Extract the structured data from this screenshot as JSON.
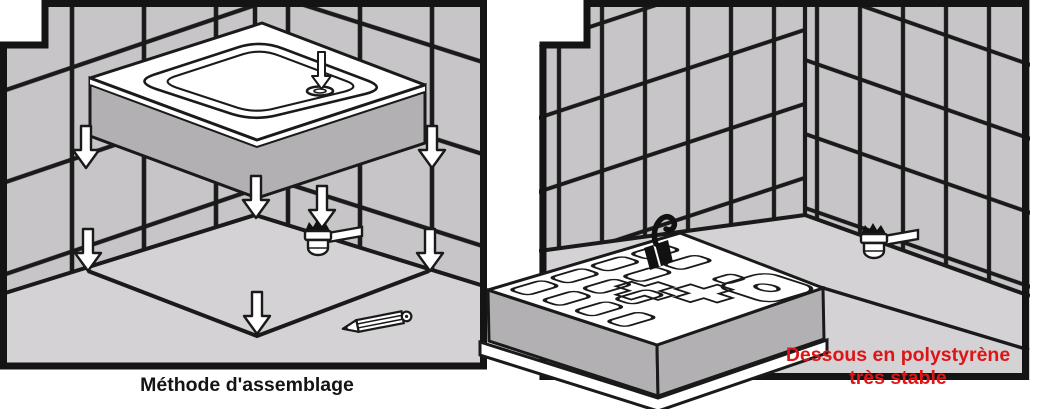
{
  "figure": {
    "type": "installation-instructions-illustration",
    "subject": "shower tray assembly in tiled corner"
  },
  "panels": {
    "left": {
      "caption": "Méthode d'assemblage",
      "elements": [
        "tiled-walls",
        "floor-marking-square",
        "shower-tray",
        "down-arrows",
        "drain-siphon",
        "pencil"
      ]
    },
    "right": {
      "caption_line1": "Dessous en polystyrène",
      "caption_line2": "très stable",
      "elements": [
        "tiled-walls",
        "polystyrene-base",
        "glue-brush",
        "drain-siphon"
      ]
    }
  },
  "icons": {
    "down_arrow": "down-arrow-icon",
    "drain_siphon": "drain-siphon-icon",
    "pencil": "pencil-icon",
    "glue_brush": "glue-brush-icon"
  },
  "colors": {
    "wall_tile": "#c7c5c7",
    "grout": "#1a1a1a",
    "floor": "#d4d2d4",
    "object_side": "#b2b0b3",
    "frame": "#141414",
    "caption_text": "#141414",
    "warning_red": "#dd1517",
    "white": "#ffffff"
  }
}
